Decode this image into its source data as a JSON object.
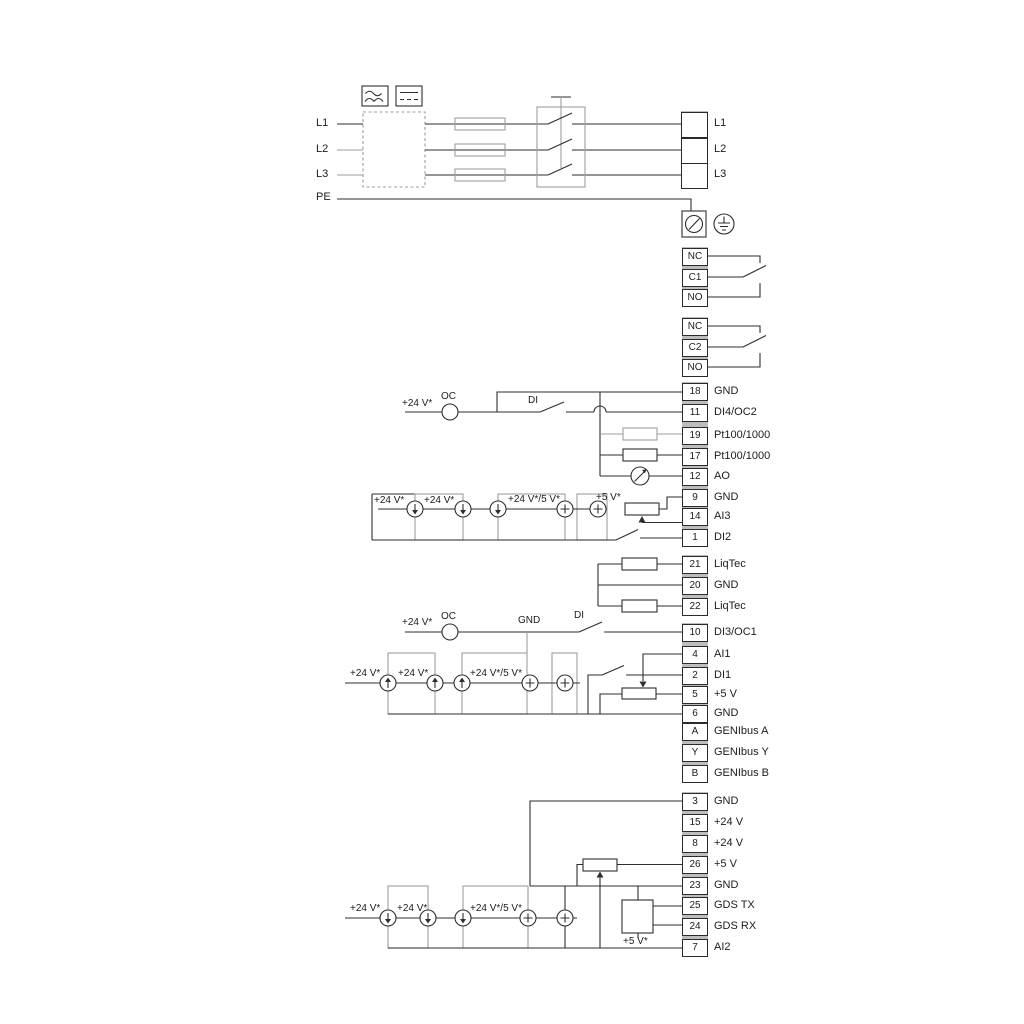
{
  "inputs": {
    "l1": "L1",
    "l2": "L2",
    "l3": "L3",
    "pe": "PE"
  },
  "power_out": [
    "L1",
    "L2",
    "L3"
  ],
  "relay1": {
    "nc": "NC",
    "c": "C1",
    "no": "NO"
  },
  "relay2": {
    "nc": "NC",
    "c": "C2",
    "no": "NO"
  },
  "io1": [
    {
      "n": "18",
      "l": "GND"
    },
    {
      "n": "11",
      "l": "DI4/OC2"
    },
    {
      "n": "19",
      "l": "Pt100/1000"
    },
    {
      "n": "17",
      "l": "Pt100/1000"
    },
    {
      "n": "12",
      "l": "AO"
    },
    {
      "n": "9",
      "l": "GND"
    },
    {
      "n": "14",
      "l": "AI3"
    },
    {
      "n": "1",
      "l": "DI2"
    }
  ],
  "liqtec": [
    {
      "n": "21",
      "l": "LiqTec"
    },
    {
      "n": "20",
      "l": "GND"
    },
    {
      "n": "22",
      "l": "LiqTec"
    }
  ],
  "io2": [
    {
      "n": "10",
      "l": "DI3/OC1"
    },
    {
      "n": "4",
      "l": "AI1"
    },
    {
      "n": "2",
      "l": "DI1"
    },
    {
      "n": "5",
      "l": "+5 V"
    },
    {
      "n": "6",
      "l": "GND"
    },
    {
      "n": "A",
      "l": "GENIbus A"
    },
    {
      "n": "Y",
      "l": "GENIbus Y"
    },
    {
      "n": "B",
      "l": "GENIbus B"
    }
  ],
  "io3": [
    {
      "n": "3",
      "l": "GND"
    },
    {
      "n": "15",
      "l": "+24 V"
    },
    {
      "n": "8",
      "l": "+24 V"
    },
    {
      "n": "26",
      "l": "+5 V"
    },
    {
      "n": "23",
      "l": "GND"
    },
    {
      "n": "25",
      "l": "GDS TX"
    },
    {
      "n": "24",
      "l": "GDS RX"
    },
    {
      "n": "7",
      "l": "AI2"
    }
  ],
  "ann": {
    "v24": "+24 V*",
    "v24_5": "+24 V*/5 V*",
    "v5": "+5 V*",
    "oc": "OC",
    "di": "DI",
    "gnd": "GND"
  },
  "colors": {
    "line": "#2e2e2e",
    "muted": "#9e9e9e"
  }
}
